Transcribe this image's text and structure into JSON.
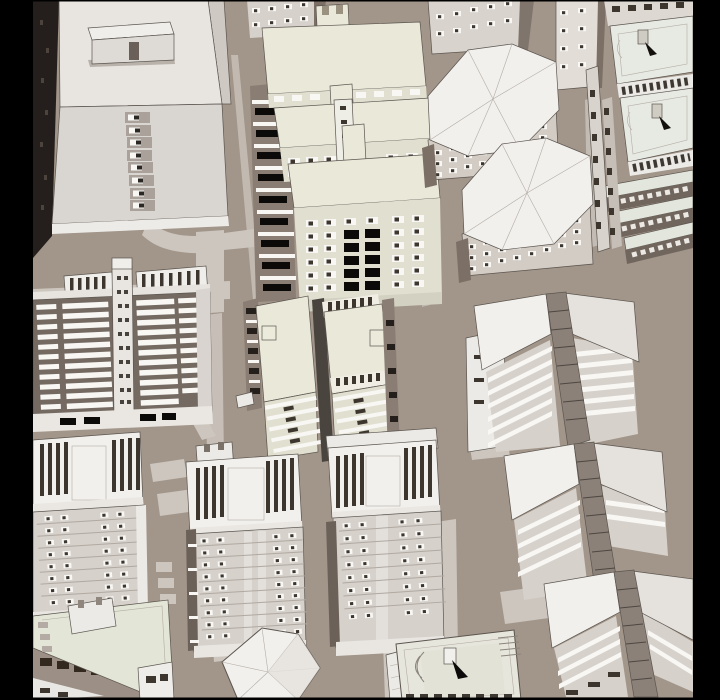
{
  "scene": {
    "description": "Aerial axonometric 3D massing render of a residential city district (modeling-software style shaded view with edge lines, letterboxed on left and right)",
    "ground": "bare mauve-taupe ground plane with light gray sidewalks and ramps",
    "buildings": [
      {
        "id": "slab-tower-plain",
        "type": "large flat-roof slab with rooftop bulkhead and central window stack"
      },
      {
        "id": "terraced-cream-complex",
        "type": "stepped cream apartment complex with black window voids"
      },
      {
        "id": "hip-roof-block-1",
        "type": "mid-rise block with white cross-hip roof and window grid"
      },
      {
        "id": "hip-roof-block-2",
        "type": "mid-rise block with white cross-hip roof and window grid"
      },
      {
        "id": "terrace-balcony-highrise",
        "type": "cascading balcony high-rise with roof terraces and statues"
      },
      {
        "id": "mid-left-slab",
        "type": "long slab with balcony strips and central elevator shaft"
      },
      {
        "id": "twin-cream-towers",
        "type": "two cream flat-roof towers with stacked balconies"
      },
      {
        "id": "point-tower-1",
        "type": "point tower, slotted roof deck and window-pair facade"
      },
      {
        "id": "point-tower-2",
        "type": "point tower, slotted roof deck and window-pair facade"
      },
      {
        "id": "point-tower-3",
        "type": "point tower, slotted roof deck and window-pair facade"
      },
      {
        "id": "butterfly-roof-block-1",
        "type": "white butterfly-roof block with dark glazed atrium core and louver facade"
      },
      {
        "id": "butterfly-roof-block-2",
        "type": "white butterfly-roof block with dark glazed atrium core and louver facade"
      },
      {
        "id": "butterfly-roof-block-3",
        "type": "white butterfly-roof block with dark glazed atrium core and louver facade"
      },
      {
        "id": "low-cream-block",
        "type": "low cream block with white roof penthouse"
      },
      {
        "id": "cross-hip-roof-block",
        "type": "white cross-gable hip roof block"
      },
      {
        "id": "courtyard-pavilion",
        "type": "flat-roof pavilion with curved parapet court, statue and side stairs"
      }
    ]
  },
  "palette": {
    "black": "#000000",
    "ground": "#a29589",
    "road": "#ccc6bf",
    "roofWhite": "#f2f0ed",
    "roofShade": "#e5e1dc",
    "wallLight": "#d6d1cb",
    "wallWhite": "#eceae6",
    "cream": "#e0dfd0",
    "creamRoof": "#e9e8d9",
    "wallShadow": "#7c7066",
    "darkSide": "#463f39",
    "glass": "#0c0a08",
    "windowWhite": "#f8f7f4",
    "windowDark": "#3c362f",
    "atrium": "#8b8179",
    "outline": "#5b554f"
  }
}
